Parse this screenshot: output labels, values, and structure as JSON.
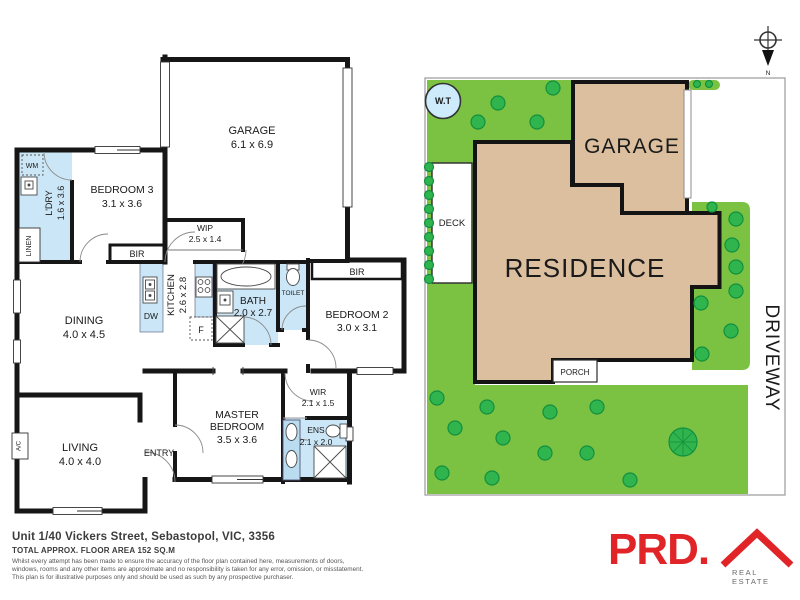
{
  "floor_plan": {
    "rooms": {
      "garage": {
        "name": "GARAGE",
        "dims": "6.1 x 6.9"
      },
      "bedroom3": {
        "name": "BEDROOM 3",
        "dims": "3.1 x 3.6"
      },
      "laundry": {
        "name": "L'DRY",
        "dims": "1.6 x 3.6"
      },
      "wip": {
        "name": "WIP",
        "dims": "2.5 x 1.4"
      },
      "kitchen": {
        "name": "KITCHEN",
        "dims": "2.6 x 2.8"
      },
      "bath": {
        "name": "BATH",
        "dims": "2.0 x 2.7"
      },
      "toilet": {
        "name": "TOILET"
      },
      "bedroom2": {
        "name": "BEDROOM 2",
        "dims": "3.0 x 3.1"
      },
      "dining": {
        "name": "DINING",
        "dims": "4.0 x 4.5"
      },
      "living": {
        "name": "LIVING",
        "dims": "4.0 x 4.0"
      },
      "master": {
        "line1": "MASTER",
        "line2": "BEDROOM",
        "dims": "3.5 x 3.6"
      },
      "wir": {
        "name": "WIR",
        "dims": "2.1 x 1.5"
      },
      "ens": {
        "name": "ENS",
        "dims": "2.1 x 2.0"
      }
    },
    "labels": {
      "wm": "WM",
      "linen": "LINEN",
      "bir": "BIR",
      "dw": "DW",
      "fridge": "F",
      "ac": "A/C",
      "entry": "ENTRY"
    }
  },
  "site_plan": {
    "garage": "GARAGE",
    "residence": "RESIDENCE",
    "deck": "DECK",
    "porch": "PORCH",
    "driveway": "DRIVEWAY",
    "water_tank": "W.T",
    "north": "N"
  },
  "footer": {
    "address": "Unit 1/40 Vickers Street, Sebastopol, VIC, 3356",
    "area": "TOTAL APPROX. FLOOR AREA 152 SQ.M",
    "disclaimer1": "Whilst every attempt has been made to ensure the accuracy of the floor plan contained here, measurements of doors,",
    "disclaimer2": "windows, rooms and any other items are approximate and no responsibility is taken for any error, omission, or misstatement.",
    "disclaimer3": "This plan is for illustrative purposes only and should be used as such by any prospective purchaser."
  },
  "logo": {
    "brand": "PRD.",
    "tagline": "REAL ESTATE"
  },
  "colors": {
    "lawn": "#7CC242",
    "tree": "#2FB44E",
    "building": "#DBBF9F",
    "wet_area": "#CBE6F6",
    "brand_red": "#E02428"
  }
}
